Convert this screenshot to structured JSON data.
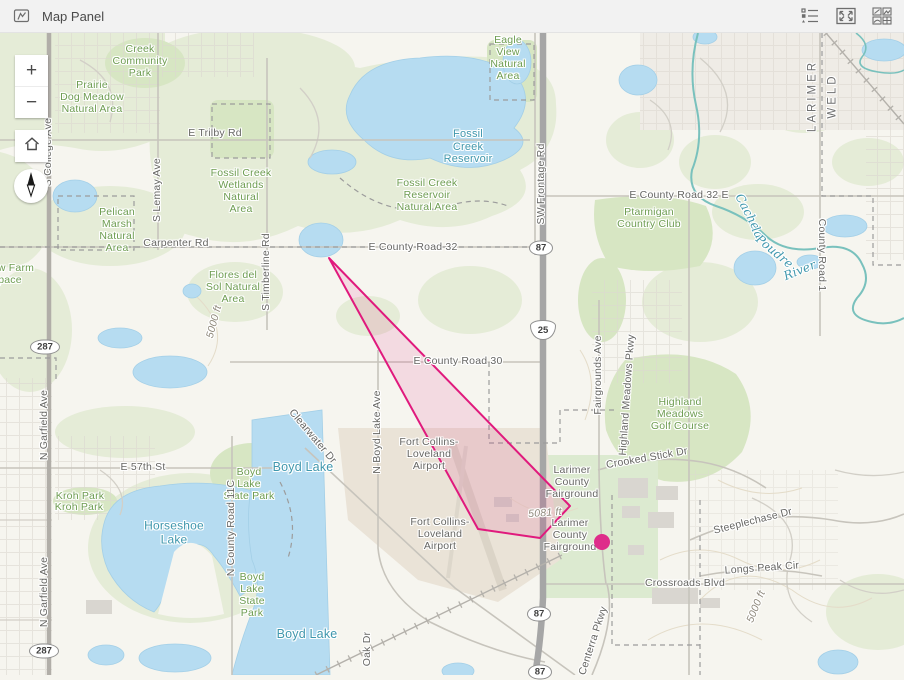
{
  "header": {
    "title": "Map Panel",
    "left_icon": "map-panel-icon",
    "right_icons": [
      "legend-icon",
      "expand-icon",
      "overview-icon"
    ]
  },
  "controls": {
    "zoom_in_label": "+",
    "zoom_out_label": "−",
    "home_icon": "home-icon",
    "compass_icon": "compass-needle-icon"
  },
  "map": {
    "overlay": {
      "polygon": {
        "points": [
          [
            329,
            258
          ],
          [
            570,
            506
          ],
          [
            540,
            538
          ],
          [
            478,
            529
          ]
        ],
        "stroke": "#e01a7d",
        "stroke_width": 2,
        "fill": "#e01a7d",
        "fill_opacity": 0.12
      },
      "marker": {
        "x": 602,
        "y": 542,
        "r": 8,
        "color": "#de2d8a"
      }
    },
    "shields": [
      {
        "type": "us",
        "label": "287",
        "x": 45,
        "y": 347
      },
      {
        "type": "us",
        "label": "287",
        "x": 44,
        "y": 651
      },
      {
        "type": "us",
        "label": "87",
        "x": 541,
        "y": 248
      },
      {
        "type": "us",
        "label": "87",
        "x": 539,
        "y": 614
      },
      {
        "type": "us",
        "label": "87",
        "x": 540,
        "y": 672
      },
      {
        "type": "interstate",
        "label": "25",
        "x": 543,
        "y": 330
      }
    ],
    "labels": [
      {
        "t": "Creek\nCommunity\nPark",
        "x": 140,
        "y": 62,
        "c": "park"
      },
      {
        "t": "Prairie\nDog Meadow\nNatural Area",
        "x": 92,
        "y": 98,
        "c": "park"
      },
      {
        "t": "Fossil Creek\nWetlands\nNatural\nArea",
        "x": 241,
        "y": 192,
        "c": "park"
      },
      {
        "t": "Pelican\nMarsh\nNatural\nArea",
        "x": 117,
        "y": 231,
        "c": "park"
      },
      {
        "t": "Eagle\nView\nNatural\nArea",
        "x": 508,
        "y": 59,
        "c": "park"
      },
      {
        "t": "Fossil Creek\nReservoir\nNatural Area",
        "x": 427,
        "y": 196,
        "c": "park"
      },
      {
        "t": "Flores del\nSol Natural\nArea",
        "x": 233,
        "y": 288,
        "c": "park"
      },
      {
        "t": "Ptarmigan\nCountry Club",
        "x": 649,
        "y": 219,
        "c": "park"
      },
      {
        "t": "Kroh Park",
        "x": 80,
        "y": 497,
        "c": "park"
      },
      {
        "t": "Kroh Park",
        "x": 79,
        "y": 508,
        "c": "park"
      },
      {
        "t": "Boyd\nLake\nState Park",
        "x": 249,
        "y": 485,
        "c": "park"
      },
      {
        "t": "Boyd\nLake\nState\nPark",
        "x": 252,
        "y": 596,
        "c": "park"
      },
      {
        "t": "Highland\nMeadows\nGolf Course",
        "x": 680,
        "y": 415,
        "c": "park"
      },
      {
        "t": "w Farm",
        "x": 16,
        "y": 269,
        "c": "park"
      },
      {
        "t": "pace",
        "x": 10,
        "y": 281,
        "c": "park"
      },
      {
        "t": "Fossil\nCreek\nReservoir",
        "x": 468,
        "y": 147,
        "c": "water"
      },
      {
        "t": "Horseshoe\nLake",
        "x": 174,
        "y": 533,
        "c": "water",
        "s": 12
      },
      {
        "t": "Boyd Lake",
        "x": 303,
        "y": 467,
        "c": "water",
        "s": 12.5
      },
      {
        "t": "Boyd Lake",
        "x": 307,
        "y": 634,
        "c": "water",
        "s": 12.5
      },
      {
        "t": "Cache",
        "x": 747,
        "y": 212,
        "c": "river",
        "r": 62
      },
      {
        "t": "la",
        "x": 757,
        "y": 233,
        "c": "river",
        "r": 62
      },
      {
        "t": "Poudre",
        "x": 774,
        "y": 252,
        "c": "river",
        "r": 40
      },
      {
        "t": "River",
        "x": 800,
        "y": 271,
        "c": "river",
        "r": -22
      },
      {
        "t": "E Trilby Rd",
        "x": 215,
        "y": 134,
        "c": "road"
      },
      {
        "t": "S Lemay Ave",
        "x": 158,
        "y": 190,
        "c": "road",
        "r": -90
      },
      {
        "t": "Carpenter Rd",
        "x": 176,
        "y": 244,
        "c": "road"
      },
      {
        "t": "E County Road 32",
        "x": 413,
        "y": 248,
        "c": "road"
      },
      {
        "t": "SW Frontage Rd",
        "x": 542,
        "y": 184,
        "c": "road",
        "r": -90
      },
      {
        "t": "E County Road 32 E",
        "x": 679,
        "y": 196,
        "c": "road"
      },
      {
        "t": "E County Road 30",
        "x": 458,
        "y": 362,
        "c": "road"
      },
      {
        "t": "S Timberline Rd",
        "x": 267,
        "y": 272,
        "c": "road",
        "r": -90
      },
      {
        "t": "N Garfield Ave",
        "x": 45,
        "y": 425,
        "c": "road",
        "r": -90
      },
      {
        "t": "N Garfield Ave",
        "x": 45,
        "y": 592,
        "c": "road",
        "r": -90
      },
      {
        "t": "S College Ave",
        "x": 49,
        "y": 152,
        "c": "road",
        "r": -90
      },
      {
        "t": "E 57th St",
        "x": 143,
        "y": 468,
        "c": "road"
      },
      {
        "t": "N County Road 11C",
        "x": 232,
        "y": 528,
        "c": "road",
        "r": -90
      },
      {
        "t": "N Boyd Lake Ave",
        "x": 378,
        "y": 432,
        "c": "road",
        "r": -90
      },
      {
        "t": "Fairgrounds Ave",
        "x": 599,
        "y": 375,
        "c": "road",
        "r": -90
      },
      {
        "t": "Highland Meadows Pkwy",
        "x": 628,
        "y": 395,
        "c": "road",
        "r": -86
      },
      {
        "t": "Crooked Stick Dr",
        "x": 647,
        "y": 459,
        "c": "road",
        "r": -10
      },
      {
        "t": "Steeplechase Dr",
        "x": 753,
        "y": 522,
        "c": "road",
        "r": -14
      },
      {
        "t": "Longs Peak Cir",
        "x": 762,
        "y": 569,
        "c": "road",
        "r": -4
      },
      {
        "t": "Crossroads Blvd",
        "x": 685,
        "y": 584,
        "c": "road"
      },
      {
        "t": "Centerra Pkwy",
        "x": 594,
        "y": 641,
        "c": "road",
        "r": -72
      },
      {
        "t": "Oak Dr",
        "x": 368,
        "y": 649,
        "c": "road",
        "r": -90
      },
      {
        "t": "Clearwater Dr",
        "x": 312,
        "y": 437,
        "c": "road",
        "r": 50
      },
      {
        "t": "County Road 1",
        "x": 821,
        "y": 255,
        "c": "road",
        "r": 90
      },
      {
        "t": "Larimer\nCounty\nFairground",
        "x": 572,
        "y": 483,
        "c": "road"
      },
      {
        "t": "Larimer\nCounty\nFairground",
        "x": 570,
        "y": 536,
        "c": "road"
      },
      {
        "t": "Fort Collins-\nLoveland\nAirport",
        "x": 429,
        "y": 455,
        "c": "road"
      },
      {
        "t": "Fort Collins-\nLoveland\nAirport",
        "x": 440,
        "y": 535,
        "c": "road"
      },
      {
        "t": "5000 ft",
        "x": 215,
        "y": 322,
        "c": "contour",
        "r": -75
      },
      {
        "t": "5081 ft",
        "x": 545,
        "y": 514,
        "c": "contour",
        "r": -4
      },
      {
        "t": "5000 ft",
        "x": 757,
        "y": 607,
        "c": "contour",
        "r": -68
      },
      {
        "t": "LARIMER",
        "x": 813,
        "y": 96,
        "c": "county",
        "r": -90
      },
      {
        "t": "WELD",
        "x": 833,
        "y": 96,
        "c": "county",
        "r": -90
      }
    ]
  }
}
